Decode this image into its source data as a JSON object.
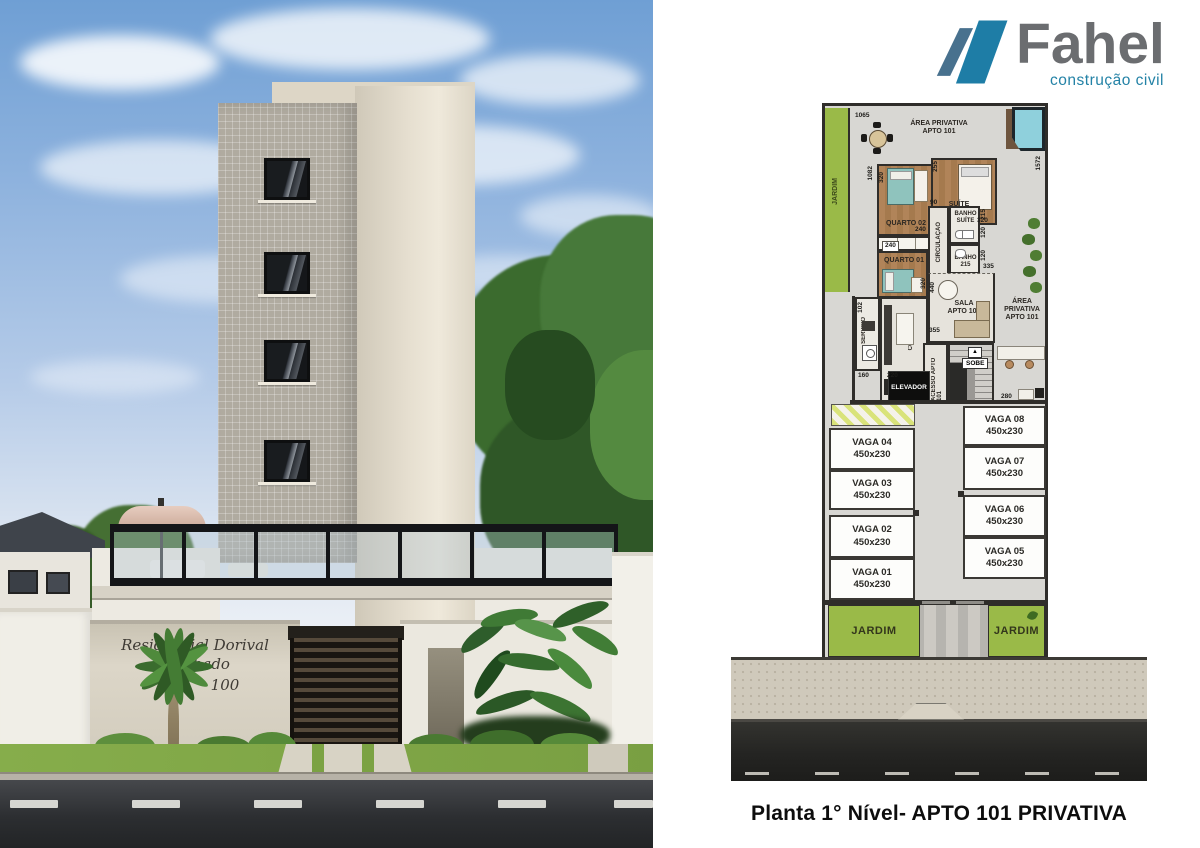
{
  "brand": {
    "name": "Fahel",
    "tagline": "construção civil",
    "name_color": "#6b6d70",
    "tagline_color": "#2382a6",
    "mark_teal": "#1e7da6",
    "mark_slate": "#48718e"
  },
  "rendering": {
    "sign_line1": "Residencial Dorival Machado",
    "sign_line2": "100"
  },
  "icons": {
    "stairs_up": "▲"
  },
  "plan": {
    "title": "Planta 1° Nível- APTO 101 PRIVATIVA",
    "labels": {
      "jardim": "JARDIM",
      "area_privativa": "ÁREA PRIVATIVA APTO 101",
      "quarto02": "QUARTO 02",
      "quarto01": "QUARTO 01",
      "suite": "SUÍTE",
      "banho_suite": "BANHO SUÍTE",
      "banho": "BANHO",
      "banho_dim": "215",
      "circulacao": "CIRCULAÇÃO",
      "cozinha": "COZINHA",
      "servico": "SERVIÇO",
      "sala": "SALA APTO 101",
      "acesso": "ACESSO APTO 101",
      "sobe": "SOBE",
      "elevador": "ELEVADOR"
    },
    "dims": {
      "top": "1065",
      "left": "1082",
      "right": "1572",
      "q2_side": "320",
      "suite_top": "255",
      "q2_width": "240",
      "closet": "240",
      "suite_width": "320",
      "circ": "90",
      "bs_depth": "215",
      "bs_width": "120",
      "banho_width": "120",
      "sala_right": "335",
      "q1_side": "320",
      "sala_side": "440",
      "cozinha_top": "355",
      "servico_side": "102",
      "servico_width": "160",
      "cozinha_width": "220",
      "hall_width": "280"
    },
    "parking": {
      "left": [
        {
          "name": "VAGA 04",
          "size": "450x230"
        },
        {
          "name": "VAGA 03",
          "size": "450x230"
        },
        {
          "name": "VAGA 02",
          "size": "450x230"
        },
        {
          "name": "VAGA 01",
          "size": "450x230"
        }
      ],
      "right": [
        {
          "name": "VAGA 08",
          "size": "450x230"
        },
        {
          "name": "VAGA 07",
          "size": "450x230"
        },
        {
          "name": "VAGA 06",
          "size": "450x230"
        },
        {
          "name": "VAGA 05",
          "size": "450x230"
        }
      ]
    },
    "colors": {
      "garden": "#9aba48",
      "wall": "#2f2d2a",
      "floor": "#d8d7d3",
      "wood": "#ab7f58",
      "pool": "#8fd0dc",
      "sidewalk": "#cfc9bb",
      "street": "#2b2b29",
      "hatch": "#d9e37a"
    }
  }
}
